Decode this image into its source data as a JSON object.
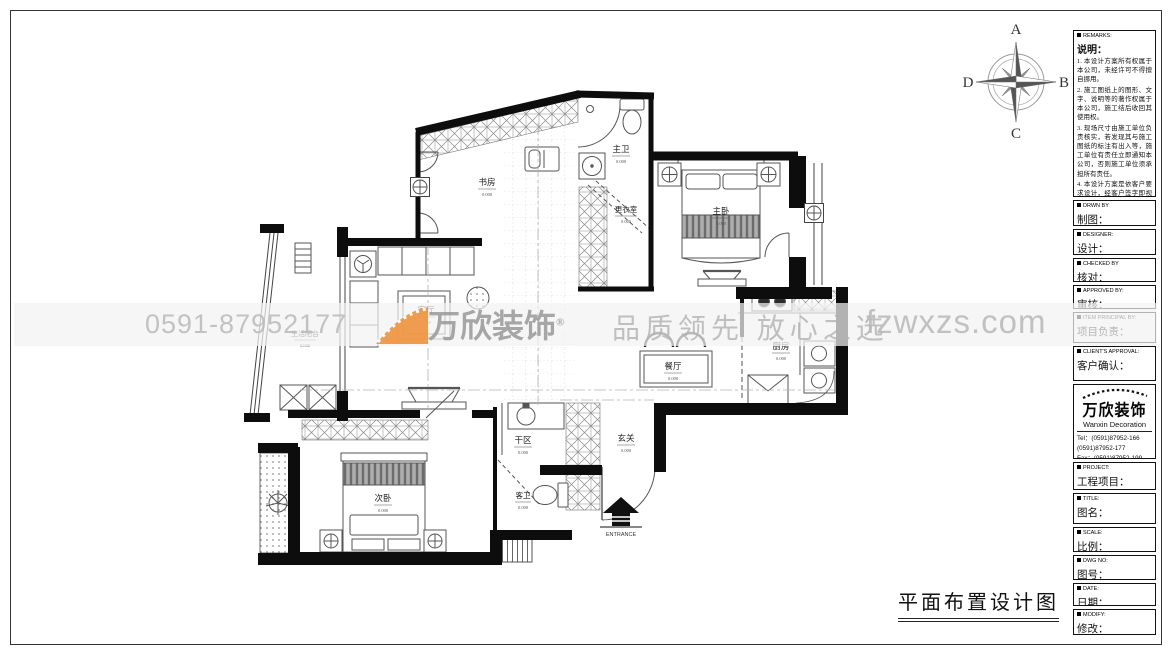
{
  "drawing_title": "平面布置设计图",
  "compass": {
    "top": "A",
    "right": "B",
    "bottom": "C",
    "left": "D"
  },
  "watermark": {
    "phone": "0591-87952177",
    "brand": "万欣装饰",
    "reg": "®",
    "slogan": "品质领先 放心之选",
    "site": "fzwxzs.com",
    "orange": "#ef923c",
    "gray": "#c7c7c7"
  },
  "floor_plan": {
    "rooms": [
      {
        "name": "书房",
        "elev": "0.000"
      },
      {
        "name": "主卫",
        "elev": "0.000"
      },
      {
        "name": "更衣室",
        "elev": "0.000"
      },
      {
        "name": "主卧",
        "elev": "0.000"
      },
      {
        "name": "客厅",
        "elev": "0.000"
      },
      {
        "name": "生活阳台",
        "elev": "0.000"
      },
      {
        "name": "餐厅",
        "elev": "0.000"
      },
      {
        "name": "厨房",
        "elev": "0.000"
      },
      {
        "name": "次卧",
        "elev": "0.000"
      },
      {
        "name": "干区",
        "elev": "0.000"
      },
      {
        "name": "玄关",
        "elev": "0.000"
      },
      {
        "name": "客卫",
        "elev": "0.000"
      }
    ],
    "entrance_label": "ENTRANCE"
  },
  "title_block": {
    "remarks": {
      "en": "REMARKS:",
      "zh": "说明：",
      "items": [
        "1. 本设计方案所有权属于本公司，未经许可不得擅自挪用。",
        "2. 施工图纸上的图形、文字、说明等的著作权属于本公司，施工结后收回其使用权。",
        "3. 现场尺寸由施工单位负责核实，若发现其与施工图纸的标注有出入等，施工单位有责任立即通知本公司，否则施工单位须承担所有责任。",
        "4. 本设计方案是依客户要求设计，经客户签字即视为同意认可，不得随意更改。"
      ]
    },
    "fields": [
      {
        "en": "DRWN BY",
        "zh": "制图："
      },
      {
        "en": "DESIGNER:",
        "zh": "设计："
      },
      {
        "en": "CHECKED BY",
        "zh": "核对："
      },
      {
        "en": "APPROVED BY:",
        "zh": "审核："
      },
      {
        "en": "ITEM PRINCIPAL BY:",
        "zh": "项目负责："
      },
      {
        "en": "CLIENT'S APPROVAL:",
        "zh": "客户确认："
      }
    ],
    "company": {
      "logo": "万欣装饰",
      "logo_en": "Wanxin Decoration",
      "tel1": "Tel：(0591)87952-166",
      "tel2": "(0591)87952-177",
      "fax": "Fax：(0591)87952-199",
      "web": "Web：WWW.fzwxzs.com"
    },
    "fields2": [
      {
        "en": "PROJECT:",
        "zh": "工程项目："
      },
      {
        "en": "TITLE:",
        "zh": "图名："
      },
      {
        "en": "SCALE:",
        "zh": "比例："
      },
      {
        "en": "DWG NO:",
        "zh": "图号："
      },
      {
        "en": "DATE:",
        "zh": "日期："
      },
      {
        "en": "MODIFY:",
        "zh": "修改："
      }
    ]
  }
}
